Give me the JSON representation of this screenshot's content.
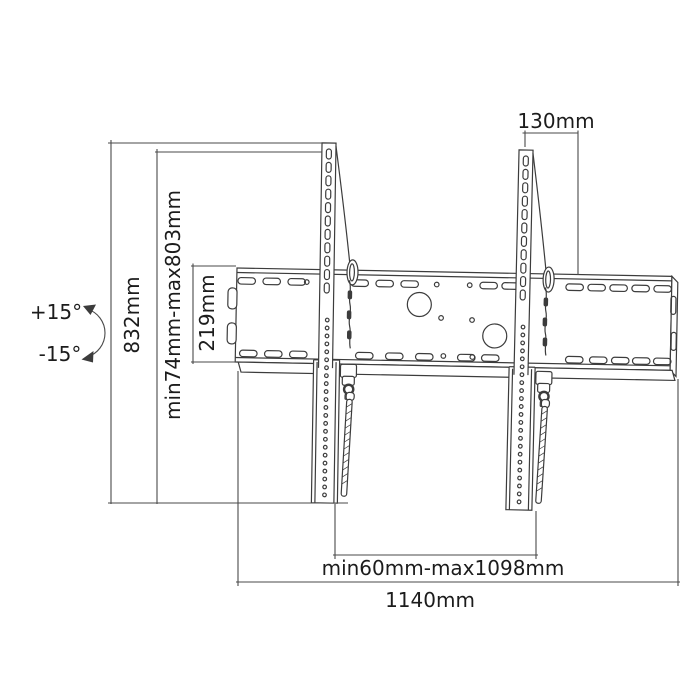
{
  "title": "Tilting TV wall mount bracket - dimensional line drawing",
  "colors": {
    "background": "#ffffff",
    "line_art": "#3c3c3c",
    "dimension_lines": "#4a4a4a",
    "label_text": "#1c1c1c"
  },
  "labels": {
    "tilt_up": "+15°",
    "tilt_down": "-15°",
    "total_height": "832mm",
    "height_range": "min74mm-max803mm",
    "wall_plate_height": "219mm",
    "top_offset": "130mm",
    "bracket_spacing_range": "min60mm-max1098mm",
    "wall_plate_width": "1140mm"
  }
}
